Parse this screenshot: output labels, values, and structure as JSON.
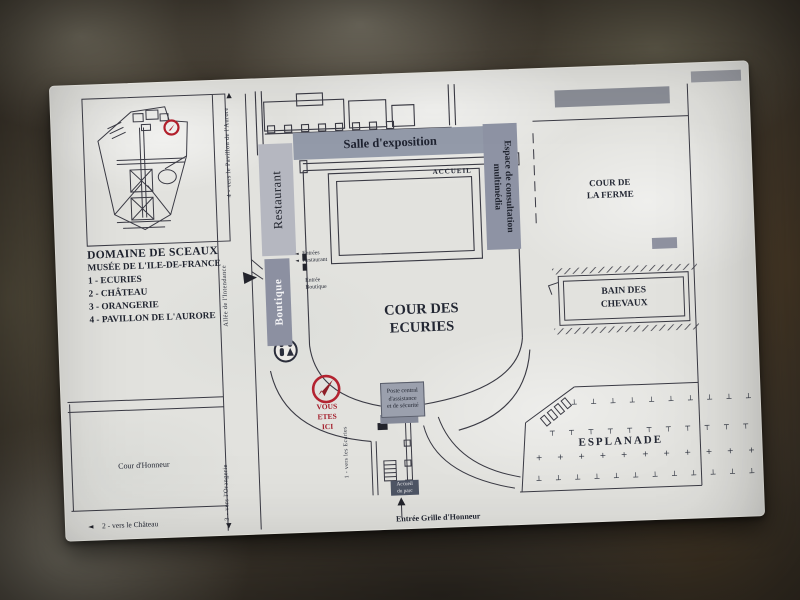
{
  "inset": {
    "title": "DOMAINE DE SCEAUX",
    "subtitle": "MUSÉE DE L'ILE-DE-FRANCE",
    "items": [
      "1 - ECURIES",
      "2 - CHÂTEAU",
      "3 - ORANGERIE",
      "4 - PAVILLON DE L'AURORE"
    ]
  },
  "zones": {
    "salle_exposition": "Salle d'exposition",
    "espace_multimedia": "Espace de consultation\nmultimédia",
    "restaurant": "Restaurant",
    "boutique": "Boutique",
    "accueil": "ACCUEIL",
    "cour_des_ecuries": "COUR DES\nECURIES",
    "cour_de_la_ferme": "COUR DE\nLA FERME",
    "bain_des_chevaux": "BAIN DES\nCHEVAUX",
    "esplanade": "ESPLANADE",
    "cour_honneur": "Cour d'Honneur"
  },
  "markers": {
    "vous_etes_ici": "VOUS\nETES\nICI",
    "poste_central": "Poste central\nd'assistance\net de sécurité",
    "accueil_du_parc": "Accueil\ndu parc",
    "entrees_restaurant": "Entrées\nRestaurant",
    "entree_boutique": "Entrée\nBoutique",
    "entree_grille": "Entrée Grille d'Honneur"
  },
  "directions": {
    "pavillon_aurore": "4 - vers le Pavillon de l'Aurore",
    "allee_intendance": "Allée de l'Intendance",
    "orangerie": "3 - vers l'Orangerie",
    "chateau": "2 - vers le Château",
    "ecuries": "1 - vers les Ecuries"
  },
  "symbols": {
    "arrow_up": "▲",
    "arrow_down": "▼",
    "arrow_left": "◄",
    "trees_row1": "┴ ┴ ┴ ┴ ┴ ┴ ┴ ┴ ┴ ┴ ┴",
    "trees_row2": "┬ ┬ ┬ ┬ ┬ ┬ ┬ ┬ ┬ ┬ ┬ ┬",
    "trees_row3": "+ + + + + + + + + + + + +",
    "trees_row4": "┴ ┴ ┴ ┴ ┴ ┴ ┴ ┴ ┴ ┴ ┴ ┴ ┴"
  },
  "colors": {
    "band_gray": "#939aa9",
    "band_light": "#b5b7c0",
    "band_dark": "#8c90a1",
    "red_marker": "#b32330",
    "line": "#3a3a44",
    "panel": "#e2e2de"
  }
}
